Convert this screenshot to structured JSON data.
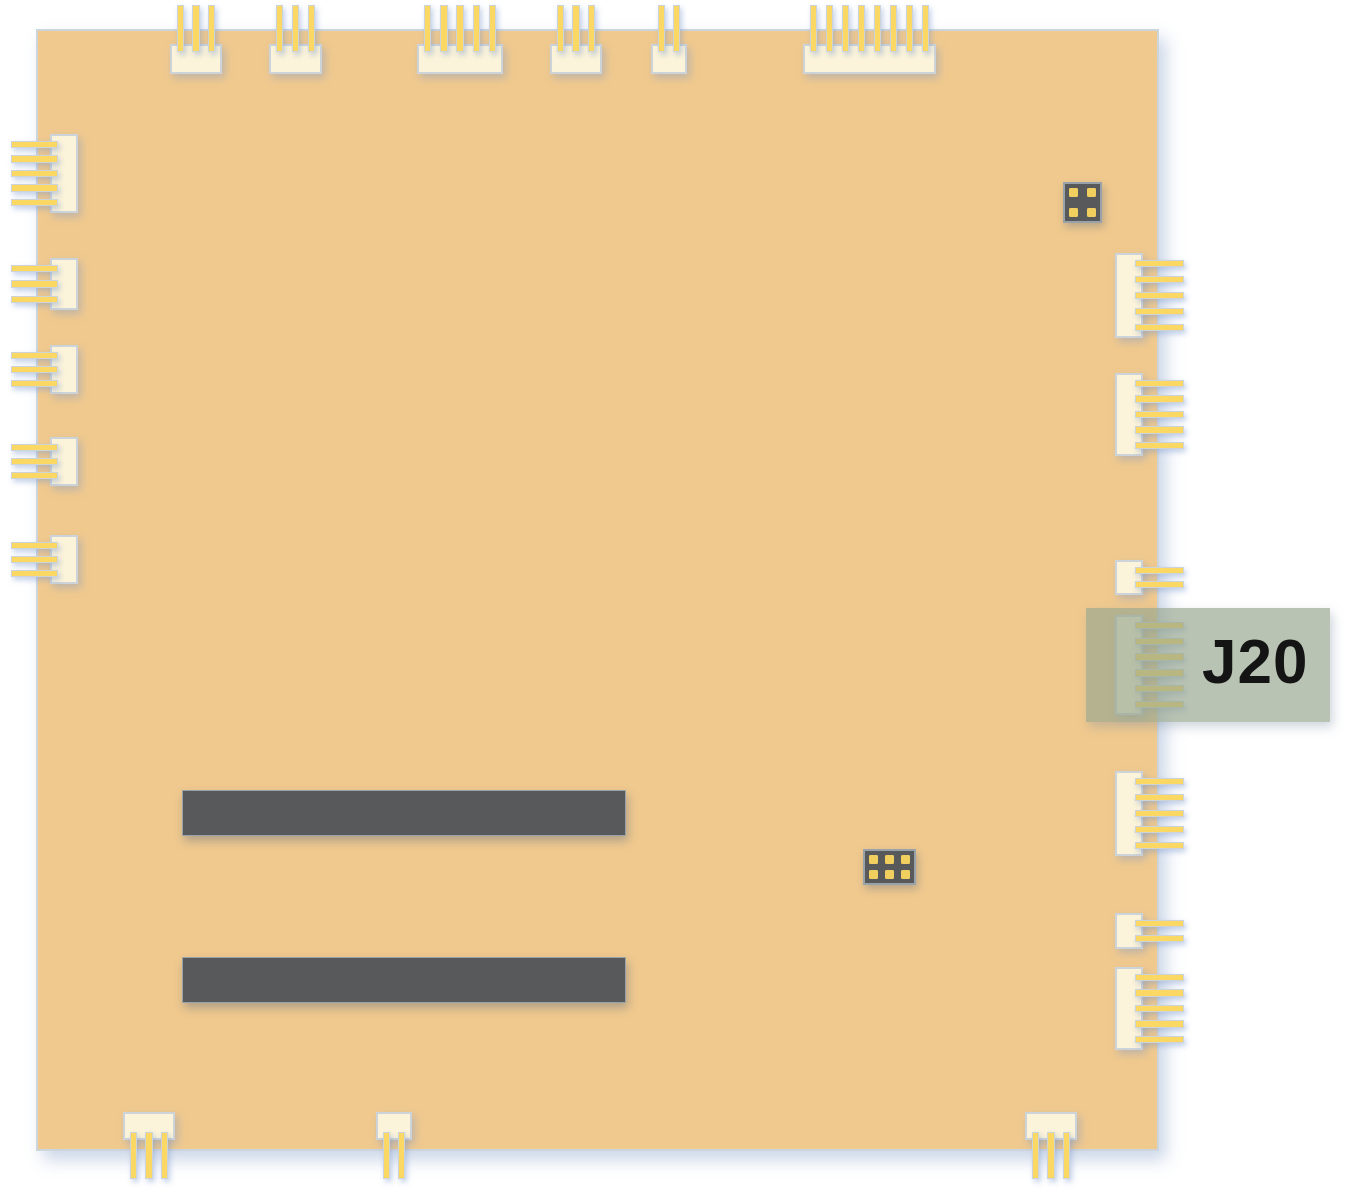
{
  "highlight": {
    "label": "J20",
    "x": 1086,
    "y": 608,
    "width": 244,
    "height": 114,
    "fill": "rgba(152,166,143,0.68)",
    "label_color": "#141414"
  },
  "colors": {
    "page_background": "#ffffff",
    "board_fill": "#f0c98e",
    "board_border": "#ccd4dc",
    "connector_fill": "#fcf4da",
    "connector_border": "#ccd3d9",
    "pin_fill": "#fbd763",
    "pin_border": "#ccd3d9",
    "component_dark_fill": "#58595b",
    "component_dark_border": "#99a1a9",
    "pad_dot_fill": "#f0cf5f"
  },
  "board": {
    "x": 36,
    "y": 29,
    "width": 1123,
    "height": 1122
  },
  "connectors": [
    {
      "id": "top-1",
      "side": "top",
      "x": 170,
      "y": 44,
      "width": 52,
      "height": 30,
      "pins": 3
    },
    {
      "id": "top-2",
      "side": "top",
      "x": 269,
      "y": 44,
      "width": 53,
      "height": 30,
      "pins": 3
    },
    {
      "id": "top-3",
      "side": "top",
      "x": 417,
      "y": 44,
      "width": 86,
      "height": 30,
      "pins": 5
    },
    {
      "id": "top-4",
      "side": "top",
      "x": 550,
      "y": 44,
      "width": 52,
      "height": 30,
      "pins": 3
    },
    {
      "id": "top-5",
      "side": "top",
      "x": 651,
      "y": 44,
      "width": 36,
      "height": 30,
      "pins": 2
    },
    {
      "id": "top-6",
      "side": "top",
      "x": 803,
      "y": 44,
      "width": 133,
      "height": 30,
      "pins": 8
    },
    {
      "id": "left-1",
      "side": "left",
      "x": 50,
      "y": 134,
      "width": 28,
      "height": 79,
      "pins": 5
    },
    {
      "id": "left-2",
      "side": "left",
      "x": 50,
      "y": 258,
      "width": 28,
      "height": 52,
      "pins": 3
    },
    {
      "id": "left-3",
      "side": "left",
      "x": 50,
      "y": 345,
      "width": 28,
      "height": 49,
      "pins": 3
    },
    {
      "id": "left-4",
      "side": "left",
      "x": 50,
      "y": 437,
      "width": 28,
      "height": 49,
      "pins": 3
    },
    {
      "id": "left-5",
      "side": "left",
      "x": 50,
      "y": 535,
      "width": 28,
      "height": 49,
      "pins": 3
    },
    {
      "id": "right-1",
      "side": "right",
      "x": 1115,
      "y": 253,
      "width": 28,
      "height": 85,
      "pins": 5
    },
    {
      "id": "right-2",
      "side": "right",
      "x": 1115,
      "y": 373,
      "width": 28,
      "height": 83,
      "pins": 5
    },
    {
      "id": "right-3",
      "side": "right",
      "x": 1115,
      "y": 560,
      "width": 28,
      "height": 35,
      "pins": 2
    },
    {
      "id": "right-j20",
      "side": "right",
      "x": 1115,
      "y": 615,
      "width": 28,
      "height": 100,
      "pins": 6
    },
    {
      "id": "right-5",
      "side": "right",
      "x": 1115,
      "y": 771,
      "width": 28,
      "height": 85,
      "pins": 5
    },
    {
      "id": "right-6",
      "side": "right",
      "x": 1115,
      "y": 913,
      "width": 28,
      "height": 36,
      "pins": 2
    },
    {
      "id": "right-7",
      "side": "right",
      "x": 1115,
      "y": 967,
      "width": 28,
      "height": 83,
      "pins": 5
    },
    {
      "id": "bottom-1",
      "side": "bottom",
      "x": 123,
      "y": 1112,
      "width": 52,
      "height": 28,
      "pins": 3
    },
    {
      "id": "bottom-2",
      "side": "bottom",
      "x": 376,
      "y": 1112,
      "width": 36,
      "height": 28,
      "pins": 2
    },
    {
      "id": "bottom-3",
      "side": "bottom",
      "x": 1025,
      "y": 1112,
      "width": 52,
      "height": 28,
      "pins": 3
    }
  ],
  "slots": [
    {
      "id": "slot-1",
      "x": 182,
      "y": 790,
      "width": 444,
      "height": 46
    },
    {
      "id": "slot-2",
      "x": 182,
      "y": 957,
      "width": 444,
      "height": 46
    }
  ],
  "chips": [
    {
      "id": "chip-4pad",
      "x": 1063,
      "y": 182,
      "width": 39,
      "height": 41,
      "pad_cols": 2,
      "pad_rows": 2
    },
    {
      "id": "chip-6pad",
      "x": 863,
      "y": 849,
      "width": 53,
      "height": 36,
      "pad_cols": 3,
      "pad_rows": 2
    }
  ]
}
